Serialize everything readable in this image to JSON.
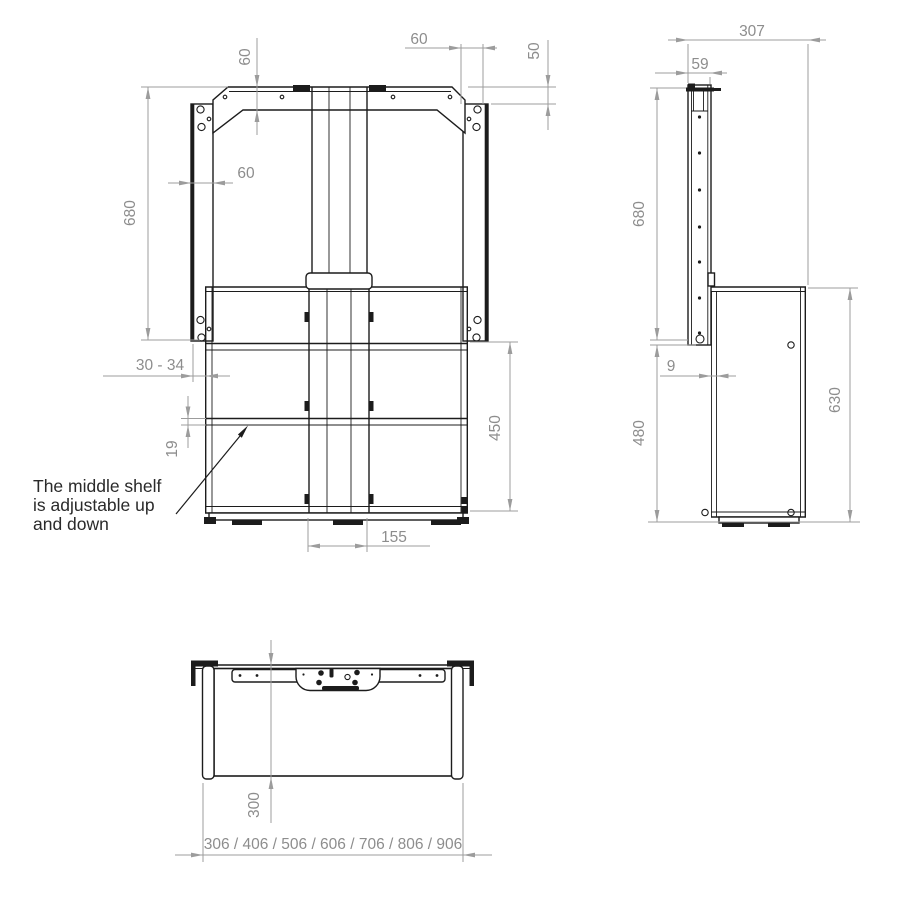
{
  "annotation": {
    "lines": [
      "The middle shelf",
      "is adjustable up",
      "and down"
    ]
  },
  "front_view": {
    "dims": {
      "bracket_height": "60",
      "anchor_offset": "60",
      "rail_top_offset": "50",
      "rail_width": "60",
      "total_height": "680",
      "rail_gap": "30 - 34",
      "shelf_thickness": "19",
      "inner_height": "450",
      "column_width": "155"
    }
  },
  "side_view": {
    "dims": {
      "total_depth": "307",
      "column_depth": "59",
      "total_height": "680",
      "panel_gap": "9",
      "lower_height": "480",
      "cabinet_height": "630"
    }
  },
  "bottom_view": {
    "dims": {
      "depth": "300",
      "width_options": "306 / 406 / 506 / 606 / 706 / 806 / 906"
    }
  },
  "colors": {
    "line": "#1c1c1c",
    "dimension_line": "#9c9c9c",
    "dimension_text": "#8d8d8d",
    "annotation_text": "#2a2a2a",
    "background": "#ffffff"
  }
}
